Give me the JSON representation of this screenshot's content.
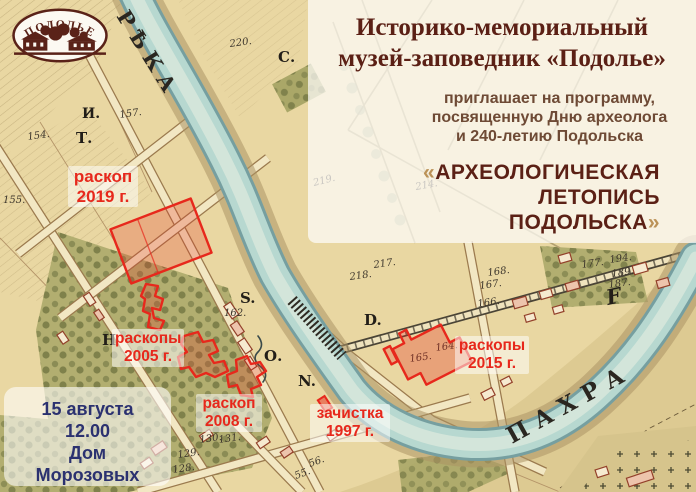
{
  "logo": {
    "text": "ПОДОЛЬЕ"
  },
  "poster": {
    "museum_title_line1": "Историко-мемориальный",
    "museum_title_line2": "музей-заповедник «Подолье»",
    "invite_lines": [
      "приглашает на программу,",
      "посвященную Дню археолога",
      "и 240-летию Подольска"
    ],
    "program": {
      "quote_open": "«",
      "line1": "АРХЕОЛОГИЧЕСКАЯ",
      "line2": "ЛЕТОПИСЬ",
      "line3": "ПОДОЛЬСКА",
      "quote_close": "»"
    }
  },
  "event": {
    "date": "15 августа",
    "time": "12.00",
    "venue_line1": "Дом",
    "venue_line2": "Морозовых"
  },
  "annotations": [
    {
      "id": "excavation-2019",
      "line1": "раскоп",
      "line2": "2019 г."
    },
    {
      "id": "excavations-2005",
      "line1": "раскопы",
      "line2": "2005 г."
    },
    {
      "id": "excavation-2008",
      "line1": "раскоп",
      "line2": "2008 г."
    },
    {
      "id": "cleanup-1997",
      "line1": "зачистка",
      "line2": "1997 г."
    },
    {
      "id": "excavations-2015",
      "line1": "раскопы",
      "line2": "2015 г."
    }
  ],
  "map": {
    "river_label_upper": "РѢКА",
    "river_label_lower": "ПАХРА",
    "letters": [
      {
        "t": "И.",
        "x": 82,
        "y": 118,
        "s": 14
      },
      {
        "t": "Т.",
        "x": 76,
        "y": 143,
        "s": 15
      },
      {
        "t": "С.",
        "x": 278,
        "y": 62,
        "s": 15
      },
      {
        "t": "S.",
        "x": 240,
        "y": 303,
        "s": 15
      },
      {
        "t": "О.",
        "x": 264,
        "y": 361,
        "s": 15
      },
      {
        "t": "N.",
        "x": 298,
        "y": 386,
        "s": 15
      },
      {
        "t": "D.",
        "x": 364,
        "y": 325,
        "s": 15
      },
      {
        "t": "Н",
        "x": 102,
        "y": 345,
        "s": 15
      },
      {
        "t": "F",
        "x": 608,
        "y": 305,
        "s": 21,
        "i": true,
        "r": -12
      }
    ],
    "numbers": [
      {
        "t": "220.",
        "x": 230,
        "y": 47,
        "r": -8
      },
      {
        "t": "157.",
        "x": 120,
        "y": 118,
        "r": -8
      },
      {
        "t": "154.",
        "x": 28,
        "y": 140,
        "r": -8
      },
      {
        "t": "155.",
        "x": 3,
        "y": 203,
        "r": 0
      },
      {
        "t": "162.",
        "x": 224,
        "y": 316,
        "r": 0
      },
      {
        "t": "219.",
        "x": 314,
        "y": 186,
        "r": -14
      },
      {
        "t": "214.",
        "x": 416,
        "y": 190,
        "r": -10
      },
      {
        "t": "217.",
        "x": 374,
        "y": 268,
        "r": -8
      },
      {
        "t": "218.",
        "x": 350,
        "y": 280,
        "r": -8
      },
      {
        "t": "168.",
        "x": 488,
        "y": 276,
        "r": -8
      },
      {
        "t": "167.",
        "x": 480,
        "y": 289,
        "r": -8
      },
      {
        "t": "166.",
        "x": 478,
        "y": 307,
        "r": -8
      },
      {
        "t": "165.",
        "x": 410,
        "y": 362,
        "r": -8
      },
      {
        "t": "164.",
        "x": 436,
        "y": 351,
        "r": -8
      },
      {
        "t": "177.",
        "x": 582,
        "y": 268,
        "r": -8
      },
      {
        "t": "194.",
        "x": 610,
        "y": 263,
        "r": -8
      },
      {
        "t": "189.",
        "x": 612,
        "y": 277,
        "r": -8
      },
      {
        "t": "187.",
        "x": 609,
        "y": 288,
        "r": -8
      },
      {
        "t": "130.",
        "x": 200,
        "y": 443,
        "r": -8
      },
      {
        "t": "131.",
        "x": 219,
        "y": 443,
        "r": -8
      },
      {
        "t": "129.",
        "x": 178,
        "y": 458,
        "r": -8
      },
      {
        "t": "128.",
        "x": 173,
        "y": 473,
        "r": -8
      },
      {
        "t": "56.",
        "x": 310,
        "y": 467,
        "r": -20
      },
      {
        "t": "55.",
        "x": 296,
        "y": 479,
        "r": -20
      }
    ]
  },
  "colors": {
    "accent_red": "#e7281c",
    "title_maroon": "#5b2015",
    "invite_brown": "#6e4a35",
    "event_navy": "#2b3170",
    "quote_gold": "#bb9257",
    "map_tan": "#e9d7a2",
    "river_teal": "#b7d8d0",
    "park_green": "#b2ae70"
  }
}
